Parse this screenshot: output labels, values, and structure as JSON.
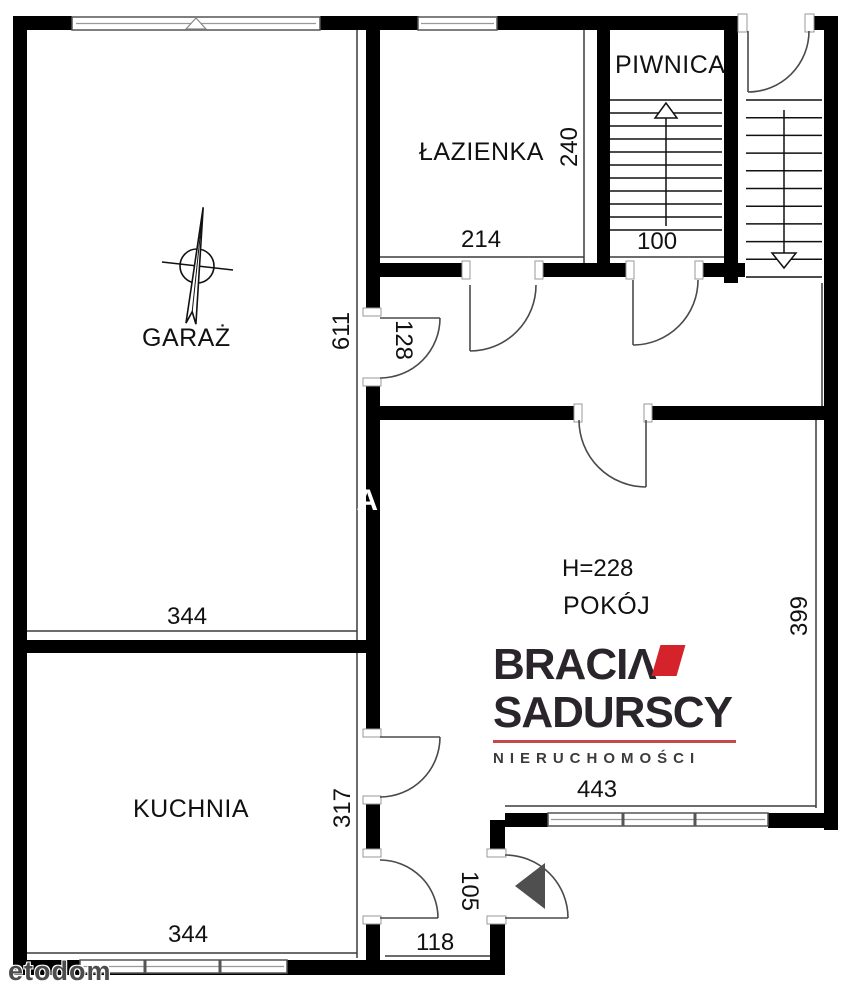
{
  "plan": {
    "rooms": {
      "garage": "GARAŻ",
      "bathroom": "ŁAZIENKA",
      "cellar": "PIWNICA",
      "room": "POKÓJ",
      "kitchen": "KUCHNIA"
    },
    "dimensions": {
      "garage_width": "344",
      "garage_depth": "611",
      "bathroom_width": "214",
      "bathroom_depth": "240",
      "cellar_width": "100",
      "garage_door_width": "128",
      "room_ceiling_height": "H=228",
      "room_width": "443",
      "room_depth": "399",
      "kitchen_depth": "317",
      "kitchen_width_bottom": "344",
      "hall_depth": "105",
      "hall_width": "118"
    },
    "symbols": {
      "north_arrow": "compass-north-arrow",
      "stairs_up": "stairs-up-arrow",
      "stairs_down": "stairs-down-arrow",
      "entrance_marker": "entrance-triangle-arrow"
    }
  },
  "logo": {
    "line1": "BRACIΛ",
    "line2": "SADURSCY",
    "line3": "NIERUCHOMOŚCI",
    "accent_color": "#d5232b",
    "text_color": "#29252b"
  },
  "watermark": {
    "text": "etodom",
    "fragment": "IA"
  },
  "colors": {
    "background": "#ffffff",
    "wall": "#000000",
    "thin_line": "#3c3c3c",
    "door_line": "#4a4a4a",
    "entry_arrow": "#4f4f4f"
  }
}
